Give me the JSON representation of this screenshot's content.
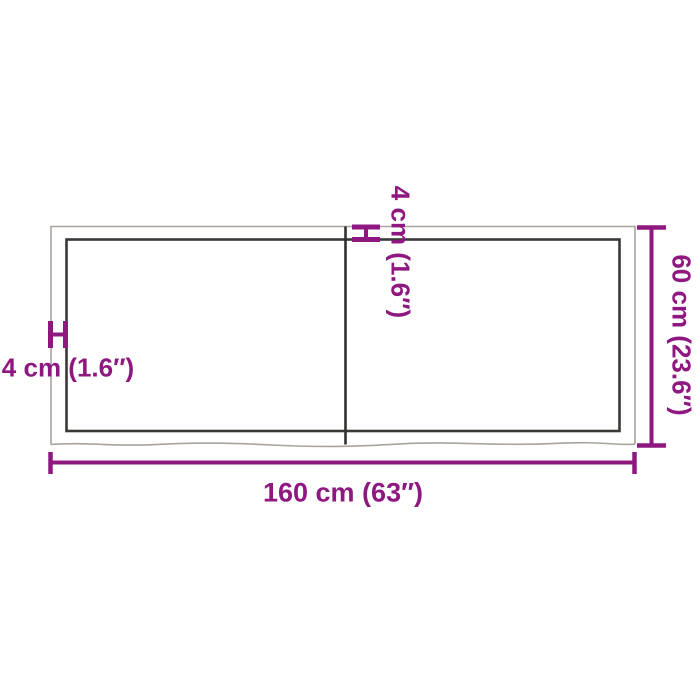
{
  "colors": {
    "accent_purple": "#8F1880",
    "line_dark": "#3B3936",
    "line_light": "#A9A39C",
    "background": "#FFFFFF"
  },
  "diagram": {
    "kind": "product-dimension-diagram",
    "object": "rectangular tabletop with live edge and center seam",
    "labels": {
      "width": "160 cm (63″)",
      "depth": "60 cm (23.6″)",
      "thickness_left": "4 cm (1.6″)",
      "thickness_top": "4 cm (1.6″)"
    },
    "dimensions": {
      "width": {
        "metric": "160 cm",
        "imperial": "63″"
      },
      "depth": {
        "metric": "60 cm",
        "imperial": "23.6″"
      },
      "thickness": {
        "metric": "4 cm",
        "imperial": "1.6″"
      }
    }
  }
}
